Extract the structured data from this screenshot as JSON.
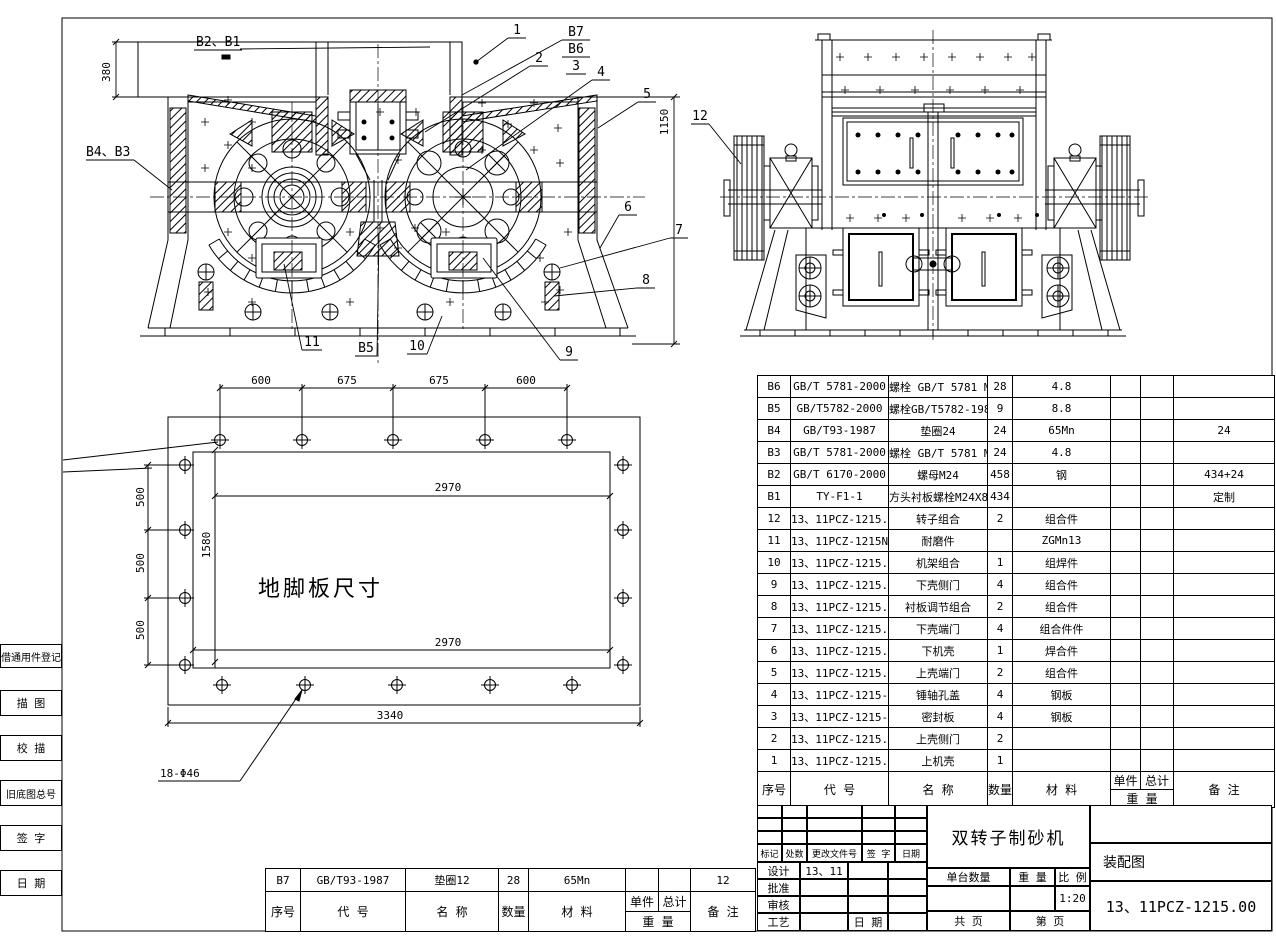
{
  "drawing": {
    "title": "双转子制砂机",
    "doc_type": "装配图",
    "drawing_no": "13、11PCZ-1215.00",
    "scale_value": "1:20",
    "design_value": "13、11"
  },
  "left_margin": {
    "items": [
      "借通用件登记",
      "描  图",
      "校  描",
      "旧底图总号",
      "签  字",
      "日  期"
    ]
  },
  "bom": {
    "headers": {
      "seq": "序号",
      "code": "代  号",
      "name": "名  称",
      "qty": "数量",
      "material": "材  料",
      "unit": "单件",
      "total": "总计",
      "weight": "重  量",
      "remark": "备  注"
    },
    "rows": [
      [
        "B6",
        "GB/T 5781-2000",
        "螺栓 GB/T 5781 M12X35",
        "28",
        "4.8",
        "",
        "",
        ""
      ],
      [
        "B5",
        "GB/T5782-2000",
        "螺栓GB/T5782-1988 M30X190",
        "9",
        "8.8",
        "",
        "",
        ""
      ],
      [
        "B4",
        "GB/T93-1987",
        "垫圈24",
        "24",
        "65Mn",
        "",
        "",
        "24"
      ],
      [
        "B3",
        "GB/T 5781-2000",
        "螺栓 GB/T 5781 M24X80",
        "24",
        "4.8",
        "",
        "",
        ""
      ],
      [
        "B2",
        "GB/T 6170-2000",
        "螺母M24",
        "458",
        "钢",
        "",
        "",
        "434+24"
      ],
      [
        "B1",
        "TY-F1-1",
        "方头衬板螺栓M24X80",
        "434",
        "",
        "",
        "",
        "定制"
      ],
      [
        "12",
        "13、11PCZ-1215.09",
        "转子组合",
        "2",
        "组合件",
        "",
        "",
        ""
      ],
      [
        "11",
        "13、11PCZ-1215NM",
        "耐磨件",
        "",
        "ZGMn13",
        "",
        "",
        ""
      ],
      [
        "10",
        "13、11PCZ-1215.08",
        "机架组合",
        "1",
        "组焊件",
        "",
        "",
        ""
      ],
      [
        "9",
        "13、11PCZ-1215.07",
        "下壳侧门",
        "4",
        "组合件",
        "",
        "",
        ""
      ],
      [
        "8",
        "13、11PCZ-1215.06",
        "衬板调节组合",
        "2",
        "组合件",
        "",
        "",
        ""
      ],
      [
        "7",
        "13、11PCZ-1215.05",
        "下壳端门",
        "4",
        "组合件件",
        "",
        "",
        ""
      ],
      [
        "6",
        "13、11PCZ-1215.04",
        "下机壳",
        "1",
        "焊合件",
        "",
        "",
        ""
      ],
      [
        "5",
        "13、11PCZ-1215.03",
        "上壳端门",
        "2",
        "组合件",
        "",
        "",
        ""
      ],
      [
        "4",
        "13、11PCZ-1215-2",
        "锤轴孔盖",
        "4",
        "钢板",
        "",
        "",
        ""
      ],
      [
        "3",
        "13、11PCZ-1215-1",
        "密封板",
        "4",
        "钢板",
        "",
        "",
        ""
      ],
      [
        "2",
        "13、11PCZ-1215.02",
        "上壳侧门",
        "2",
        "",
        "",
        "",
        ""
      ],
      [
        "1",
        "13、11PCZ-1215.01",
        "上机壳",
        "1",
        "",
        "",
        "",
        ""
      ]
    ]
  },
  "extra_bom": {
    "rows": [
      [
        "B7",
        "GB/T93-1987",
        "垫圈12",
        "28",
        "65Mn",
        "",
        "",
        "12"
      ]
    ]
  },
  "title_block": {
    "rev_headers": [
      "标记",
      "处数",
      "更改文件号",
      "签 字",
      "日期"
    ],
    "sign_labels": [
      "设计",
      "批准",
      "审核",
      "工艺"
    ],
    "design_value": "13、11",
    "date_label": "日 期",
    "qty_label": "单台数量",
    "weight_label": "重 量",
    "scale_label": "比 例",
    "scale_value": "1:20",
    "sheet_total_label": "共    页",
    "sheet_no_label": "第    页",
    "doc_type": "装配图",
    "drawing_no": "13、11PCZ-1215.00",
    "title": "双转子制砂机"
  },
  "callouts": {
    "b2b1": "B2、B1",
    "c1": "1",
    "b7": "B7",
    "b6": "B6",
    "c3": "3",
    "c2": "2",
    "c4": "4",
    "c5": "5",
    "b4b3": "B4、B3",
    "c6": "6",
    "c7": "7",
    "c8": "8",
    "c9": "9",
    "c10": "10",
    "b5": "B5",
    "c11": "11",
    "c12": "12"
  },
  "dims": {
    "d380": "380",
    "d1150": "1150",
    "top1": "600",
    "top2": "675",
    "top3": "675",
    "top4": "600",
    "left1": "500",
    "left2": "500",
    "left3": "500",
    "w_top": "2970",
    "h_left": "1580",
    "w_bottom": "2970",
    "w_total": "3340",
    "holes": "18-Φ46",
    "plate_label": "地脚板尺寸"
  }
}
